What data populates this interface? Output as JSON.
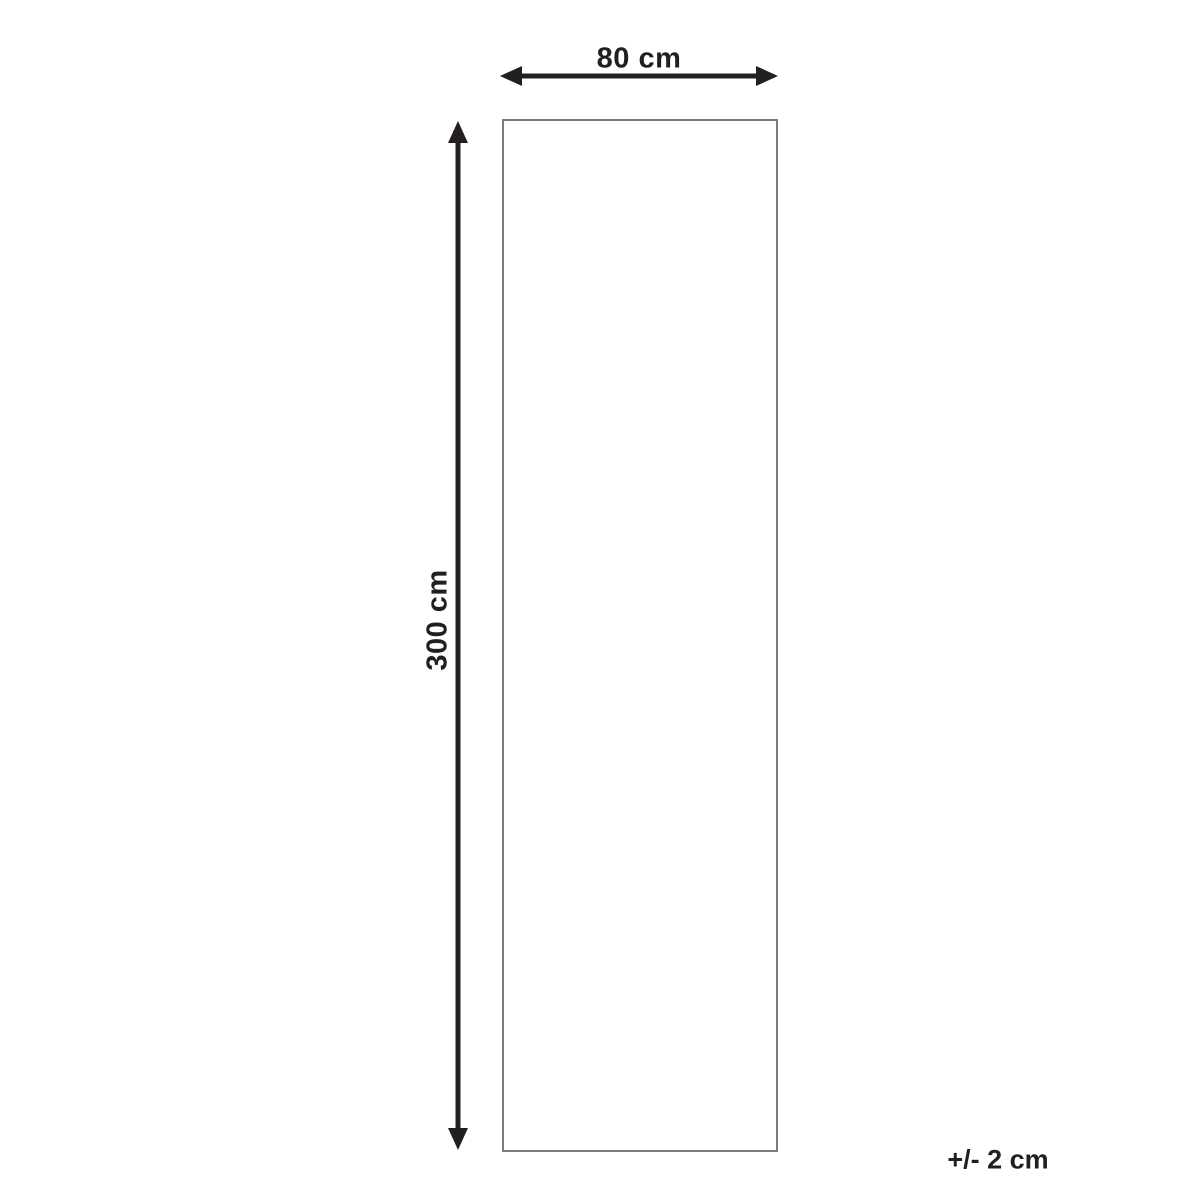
{
  "diagram": {
    "type": "product-dimensions",
    "width_label": "80 cm",
    "height_label": "300 cm",
    "tolerance_label": "+/- 2 cm",
    "shape": "rectangle",
    "colors": {
      "arrow": "#231f20",
      "rectangle_border": "#7c7d80",
      "background": "#ffffff",
      "text": "#231f20"
    }
  }
}
